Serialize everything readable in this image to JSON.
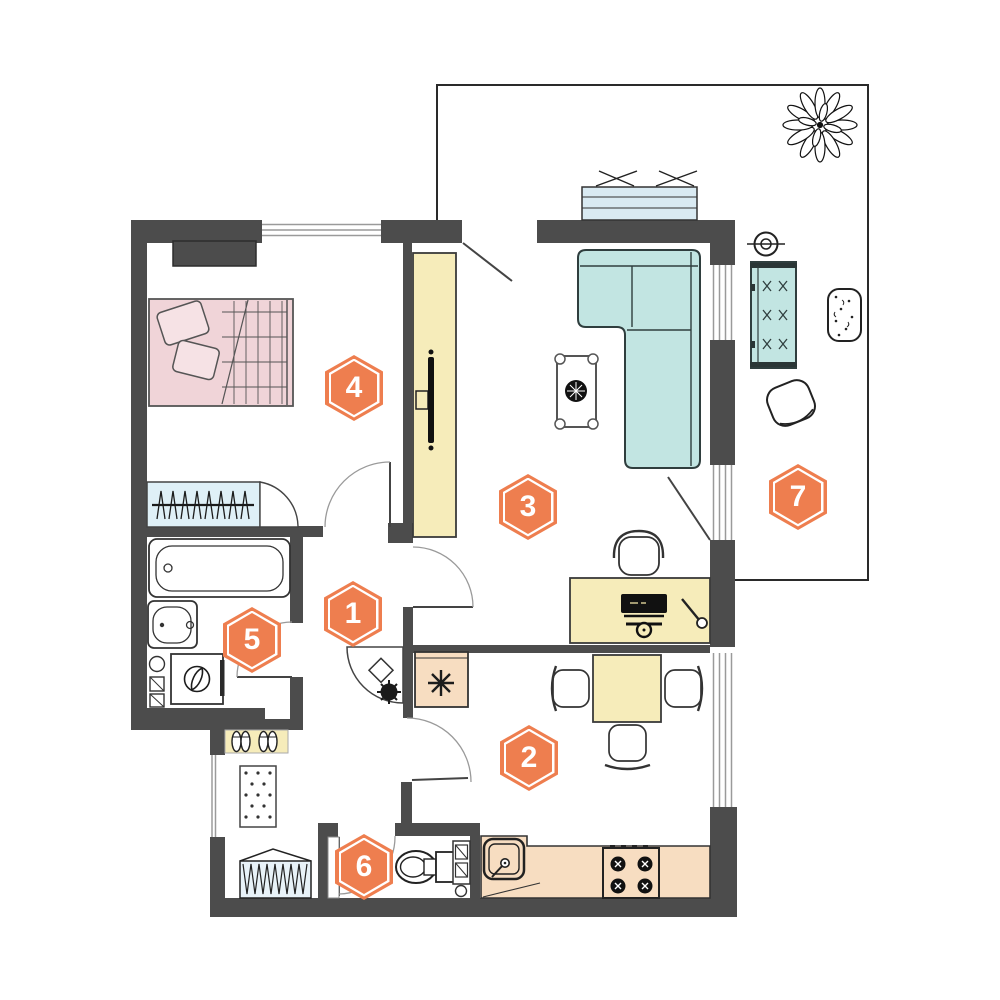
{
  "rooms": [
    {
      "label": "1"
    },
    {
      "label": "2"
    },
    {
      "label": "3"
    },
    {
      "label": "4"
    },
    {
      "label": "5"
    },
    {
      "label": "6"
    },
    {
      "label": "7"
    }
  ],
  "colors": {
    "wall": "#4c4c4c",
    "badge": "#ee7e4f",
    "furniture_yellow": "#f6ecba",
    "furniture_peach": "#f7ddc1",
    "bed_pink": "#f0d4d8",
    "sofa_teal": "#c2e5e2",
    "closet_blue": "#dff0f7",
    "planter_blue": "#d9eaf2"
  }
}
